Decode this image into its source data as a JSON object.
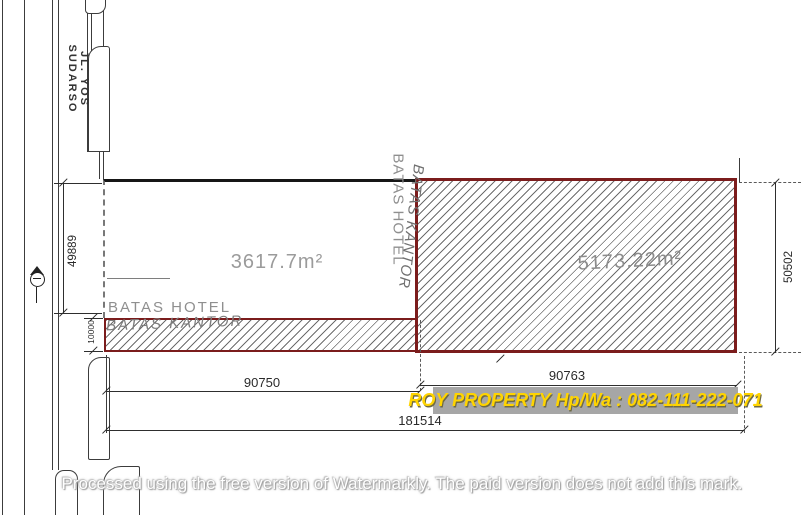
{
  "title": "Site plan drawing",
  "road": {
    "name": "JL. YOS SUDARSO"
  },
  "parcels": {
    "hotel_area": "3617.7m²",
    "office_area": "5173.22m²"
  },
  "boundaries": {
    "left_hotel": "BATAS  HOTEL",
    "left_kantor": "BATAS  KANTOR",
    "mid_kantor": "BATAS  KANTOR",
    "mid_hotel": "BATAS  HOTEL"
  },
  "dimensions": {
    "west_side": "49889",
    "strip_height": "10000",
    "east_side": "50502",
    "south_left": "90750",
    "south_right": "90763",
    "south_total": "181514"
  },
  "watermarks": {
    "banner": "ROY PROPERTY Hp/Wa : 082-111-222-071",
    "footer": "Processed using the free version of Watermarkly. The paid version does not add this mark."
  },
  "icons": {
    "benchmark": "survey-benchmark-icon"
  },
  "colors": {
    "boundary_red": "#7b1c1c",
    "boundary_black": "#161616",
    "hatch_line": "#4a4a4a",
    "label_gray": "#8f8f8f",
    "dim_text": "#2a2a2a",
    "banner_bg": "#a6a6a6",
    "banner_text": "#ffd400"
  }
}
